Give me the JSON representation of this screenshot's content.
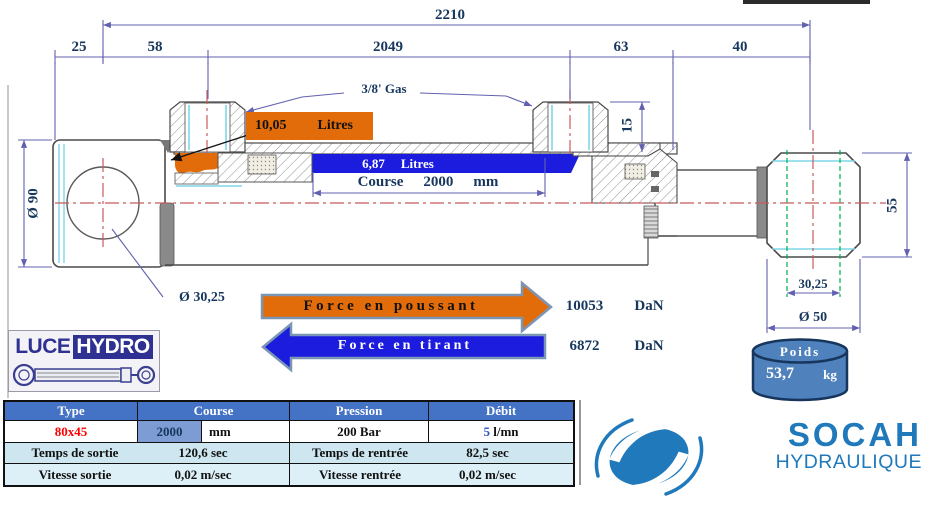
{
  "colors": {
    "navy_text": "#17375E",
    "dimension_line": "#6161B0",
    "orange_fill": "#E36C0A",
    "blue_fill": "#1C1CDE",
    "table_header_bg": "#4472C4",
    "socah_blue": "#2079BB",
    "luce_navy": "#2E3192",
    "centerline_red": "#C85A5A"
  },
  "drawing": {
    "dims": {
      "total": "2210",
      "seg_25": "25",
      "seg_58": "58",
      "seg_2049": "2049",
      "seg_63": "63",
      "seg_40": "40",
      "port_height": "15",
      "cap_diameter": "Ø 90",
      "hole_diameter": "Ø 30,25",
      "rodend_height": "55",
      "rodend_hole": "30,25",
      "rodend_diameter": "Ø 50",
      "thread": "3/8' Gas"
    },
    "push_volume": {
      "value": "10,05",
      "unit": "Litres"
    },
    "pull_volume": {
      "value": "6,87",
      "unit": "Litres"
    },
    "stroke": {
      "label": "Course",
      "value": "2000",
      "unit": "mm"
    }
  },
  "forces": {
    "push": {
      "label": "Force en poussant",
      "value": "10053",
      "unit": "DaN"
    },
    "pull": {
      "label": "Force en tirant",
      "value": "6872",
      "unit": "DaN"
    }
  },
  "weight": {
    "label": "Poids",
    "value": "53,7",
    "unit": "kg"
  },
  "table": {
    "headers": [
      "Type",
      "Course",
      "Pression",
      "Débit"
    ],
    "type_value": "80x45",
    "course_value": "2000",
    "course_unit": "mm",
    "pressure_value": "200 Bar",
    "flow_value": "5",
    "flow_unit": " l/mn",
    "out_time_label": "Temps de sortie",
    "out_time_value": "120,6 sec",
    "in_time_label": "Temps de rentrée",
    "in_time_value": "82,5 sec",
    "out_speed_label": "Vitesse sortie",
    "out_speed_value": "0,02 m/sec",
    "in_speed_label": "Vitesse rentrée",
    "in_speed_value": "0,02 m/sec"
  },
  "logos": {
    "luce": {
      "part1": "LUCE",
      "part2": "HYDRO"
    },
    "socah": {
      "name": "SOCAH",
      "subtitle": "HYDRAULIQUE"
    }
  }
}
